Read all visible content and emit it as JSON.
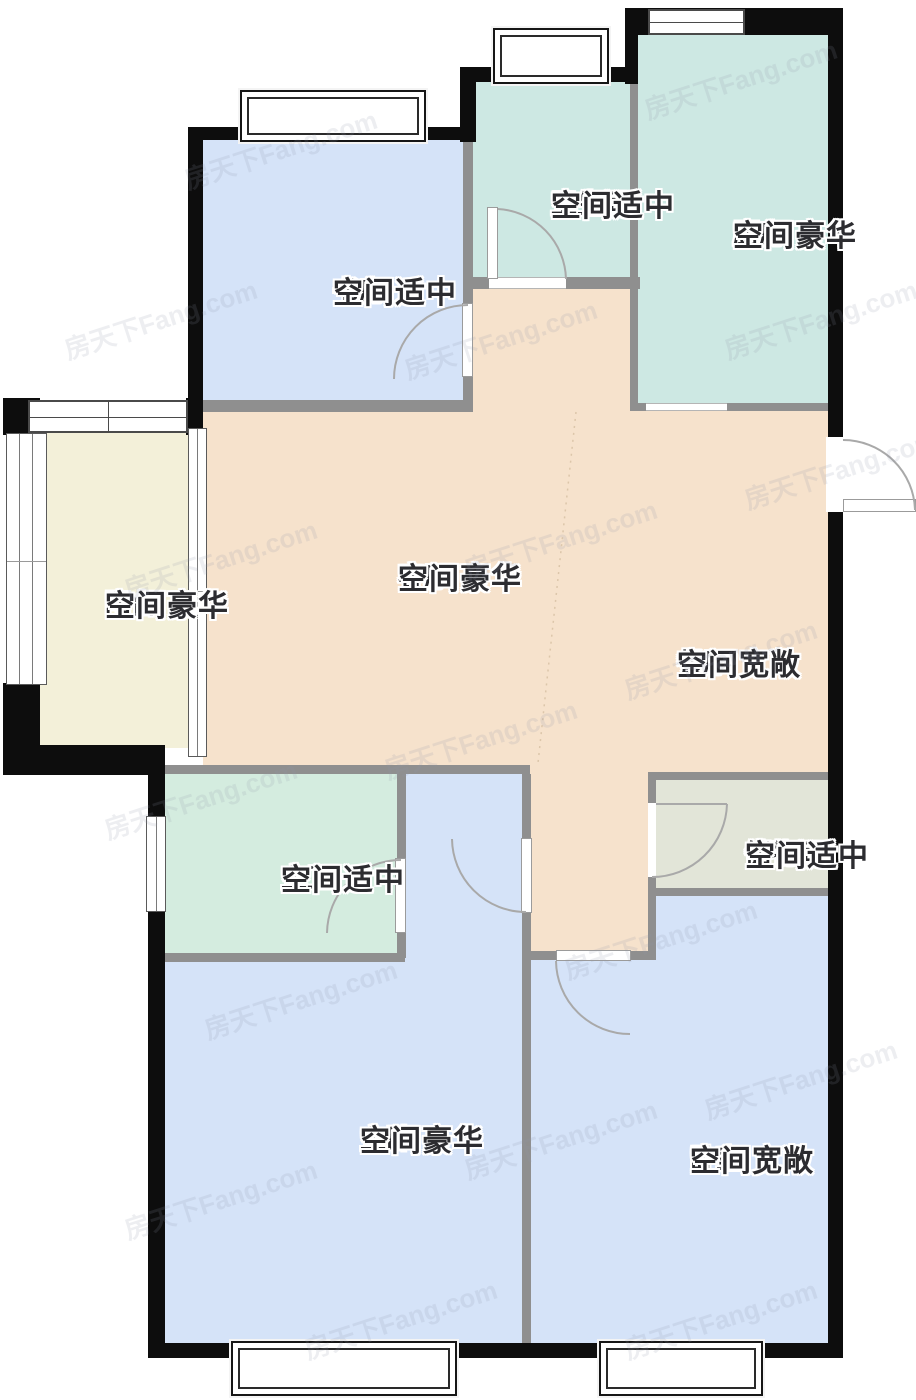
{
  "floorplan": {
    "watermark": "房天下Fang.com",
    "colors": {
      "outer_wall": "#0d0d0d",
      "inner_wall": "#8f8f8f",
      "door_arc": "#a9a9a9",
      "label_text": "#2c2c30"
    },
    "rooms": {
      "study": {
        "name": "书房",
        "desc": "空间适中",
        "color": "#d5e3f8"
      },
      "bathroom": {
        "name": "卫生间",
        "desc": "空间适中",
        "color": "#cde8e3"
      },
      "kitchen": {
        "name": "厨房",
        "desc": "空间豪华",
        "color": "#cde8e3"
      },
      "living": {
        "name": "客厅",
        "desc": "空间豪华",
        "color": "#f6e2cc"
      },
      "dining": {
        "name": "餐厅",
        "desc": "空间宽敞",
        "color": "#f6e2cc"
      },
      "balcony": {
        "name": "阳台",
        "desc": "空间豪华",
        "color": "#f3f0d9"
      },
      "master_bath": {
        "name": "主卫",
        "desc": "空间适中",
        "color": "#d4ecdf"
      },
      "storage": {
        "name": "储物间",
        "desc": "空间适中",
        "color": "#e2e5d8"
      },
      "master_bedroom": {
        "name": "主卧",
        "desc": "空间豪华",
        "color": "#d5e3f8"
      },
      "bedroom": {
        "name": "卧室",
        "desc": "空间宽敞",
        "color": "#d5e3f8"
      }
    }
  }
}
